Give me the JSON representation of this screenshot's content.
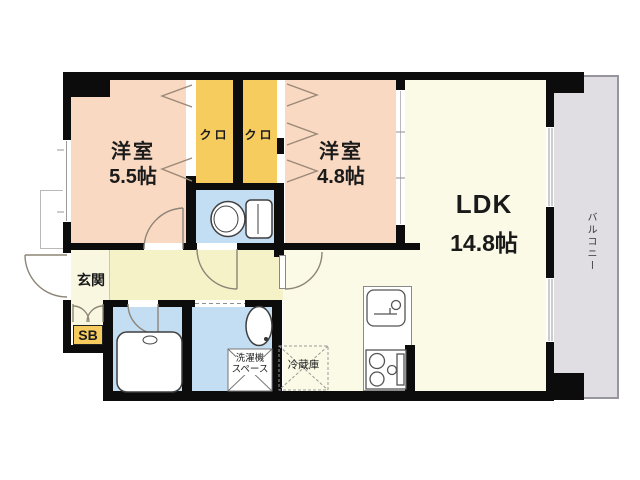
{
  "floorplan": {
    "rooms": {
      "bedroom_west_1": {
        "name": "洋室",
        "size": "5.5帖"
      },
      "bedroom_west_2": {
        "name": "洋室",
        "size": "4.8帖"
      },
      "ldk": {
        "name": "LDK",
        "size": "14.8帖"
      },
      "closet_1": "クロ",
      "closet_2": "クロ",
      "entrance": "玄関",
      "shoe_box": "SB",
      "balcony": "バルコニー",
      "washing_machine_space": [
        "洗濯機",
        "スペース"
      ],
      "refrigerator": "冷蔵庫"
    },
    "colors": {
      "wall": "#0c0c0c",
      "bedroom_floor": "#f9d9c2",
      "closet_floor": "#f6cc5e",
      "ldk_floor": "#fbfae6",
      "hall_floor": "#f6f2c8",
      "entrance_floor": "#faf7e0",
      "wet_area_floor": "#c3ddf3",
      "balcony_floor": "#e0dee3"
    }
  }
}
